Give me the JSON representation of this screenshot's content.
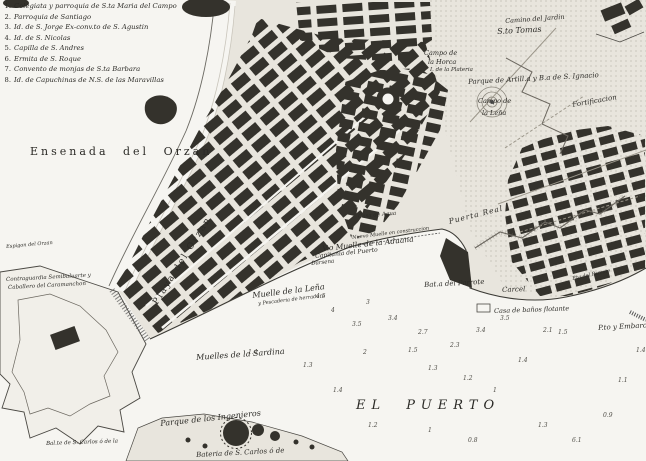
{
  "colors": {
    "ink": "#2b2a26",
    "paper": "#f6f5f1",
    "land": "#e8e5dd",
    "block": "#34322c",
    "line": "#4a4843"
  },
  "legend": {
    "items": [
      {
        "num": "1.",
        "text": "Colegiata y parroquia de S.ta Maria del Campo"
      },
      {
        "num": "2.",
        "text": "Parroquia de Santiago"
      },
      {
        "num": "3.",
        "text": "Id. de S. Jorge Ex-conv.to de S. Agustin"
      },
      {
        "num": "4.",
        "text": "Id. de S. Nicolas"
      },
      {
        "num": "5.",
        "text": "Capilla de S. Andres"
      },
      {
        "num": "6.",
        "text": "Ermita de S. Roque"
      },
      {
        "num": "7.",
        "text": "Convento de monjas de S.ta Barbara"
      },
      {
        "num": "8.",
        "text": "Id. de Capuchinas de N.S. de las Maravillas"
      }
    ]
  },
  "labels": {
    "ensenada": {
      "text": "Ensenada  del  Orzan"
    },
    "playa": {
      "text": "Playa del Orzan"
    },
    "camino_jardin": {
      "text": "Camino del Jardin"
    },
    "sto_tomas": {
      "text": "S.to Tomas"
    },
    "campo_horca_1": {
      "text": "Campo de"
    },
    "campo_horca_2": {
      "text": "la Horca"
    },
    "plateria": {
      "text": "I. de la Plateria"
    },
    "parque_artilleria": {
      "text": "Parque de Artill.a y B.a de S. Ignacio"
    },
    "campo_lena_1": {
      "text": "Campo de"
    },
    "campo_lena_2": {
      "text": "la Leña"
    },
    "fortificacion": {
      "text": "Fortificacion"
    },
    "casa_agua": {
      "text": "Casa de Agua"
    },
    "puerta_real": {
      "text": "Puerta Real"
    },
    "nuevo_muelle": {
      "text": "Nuevo Muelle en construccion"
    },
    "muelle_aduana": {
      "text": "V.o Muelle de la Aduana"
    },
    "capitania": {
      "text": "Capitania del Puerto"
    },
    "darsena": {
      "text": "Darsena"
    },
    "bat_parrote": {
      "text": "Bat.a del Parrote"
    },
    "carcel": {
      "text": "Carcel"
    },
    "pta_parrote": {
      "text": "P.ta del Parrote"
    },
    "banos": {
      "text": "Casa de baños flotante"
    },
    "pto_embarc": {
      "text": "P.to y Embarcad.o"
    },
    "el_puerto": {
      "text": "EL  PUERTO"
    },
    "sardina": {
      "text": "Muelles de la Sardina"
    },
    "muelle_lena": {
      "text": "Muelle de la Leña"
    },
    "pescaderia": {
      "text": "y Pescaderia de herradura"
    },
    "ingenieros": {
      "text": "Parque de los Ingenieros"
    },
    "bateria_carlos": {
      "text": "Bateria de S. Carlos ó de"
    },
    "baluarte": {
      "text": "Bal.te de S. Carlos ó de la"
    },
    "contraguardia_1": {
      "text": "Contraguardia Semibaluarte y"
    },
    "contraguardia_2": {
      "text": "Caballero del Caramanchon"
    },
    "espigon": {
      "text": "Espigon del Orzan"
    }
  },
  "soundings": [
    {
      "v": "4.5",
      "x": 316,
      "y": 294
    },
    {
      "v": "4",
      "x": 331,
      "y": 308
    },
    {
      "v": "3",
      "x": 366,
      "y": 300
    },
    {
      "v": "3.4",
      "x": 388,
      "y": 316
    },
    {
      "v": "2.7",
      "x": 418,
      "y": 330
    },
    {
      "v": "2.3",
      "x": 450,
      "y": 343
    },
    {
      "v": "3.4",
      "x": 476,
      "y": 328
    },
    {
      "v": "3.5",
      "x": 500,
      "y": 316
    },
    {
      "v": "2.1",
      "x": 543,
      "y": 328
    },
    {
      "v": "1.5",
      "x": 558,
      "y": 330
    },
    {
      "v": "1.4",
      "x": 518,
      "y": 358
    },
    {
      "v": "1.3",
      "x": 428,
      "y": 366
    },
    {
      "v": "1.2",
      "x": 463,
      "y": 376
    },
    {
      "v": "1",
      "x": 493,
      "y": 388
    },
    {
      "v": "2",
      "x": 363,
      "y": 350
    },
    {
      "v": "1.4",
      "x": 333,
      "y": 388
    },
    {
      "v": "1.3",
      "x": 303,
      "y": 363
    },
    {
      "v": "1.4",
      "x": 248,
      "y": 350
    },
    {
      "v": "1.5",
      "x": 408,
      "y": 348
    },
    {
      "v": "1.2",
      "x": 368,
      "y": 423
    },
    {
      "v": "1",
      "x": 428,
      "y": 428
    },
    {
      "v": "0.8",
      "x": 468,
      "y": 438
    },
    {
      "v": "1.3",
      "x": 538,
      "y": 423
    },
    {
      "v": "6.1",
      "x": 572,
      "y": 438
    },
    {
      "v": "0.9",
      "x": 603,
      "y": 413
    },
    {
      "v": "1.1",
      "x": 618,
      "y": 378
    },
    {
      "v": "1.4",
      "x": 636,
      "y": 348
    },
    {
      "v": "3.5",
      "x": 352,
      "y": 322
    }
  ]
}
